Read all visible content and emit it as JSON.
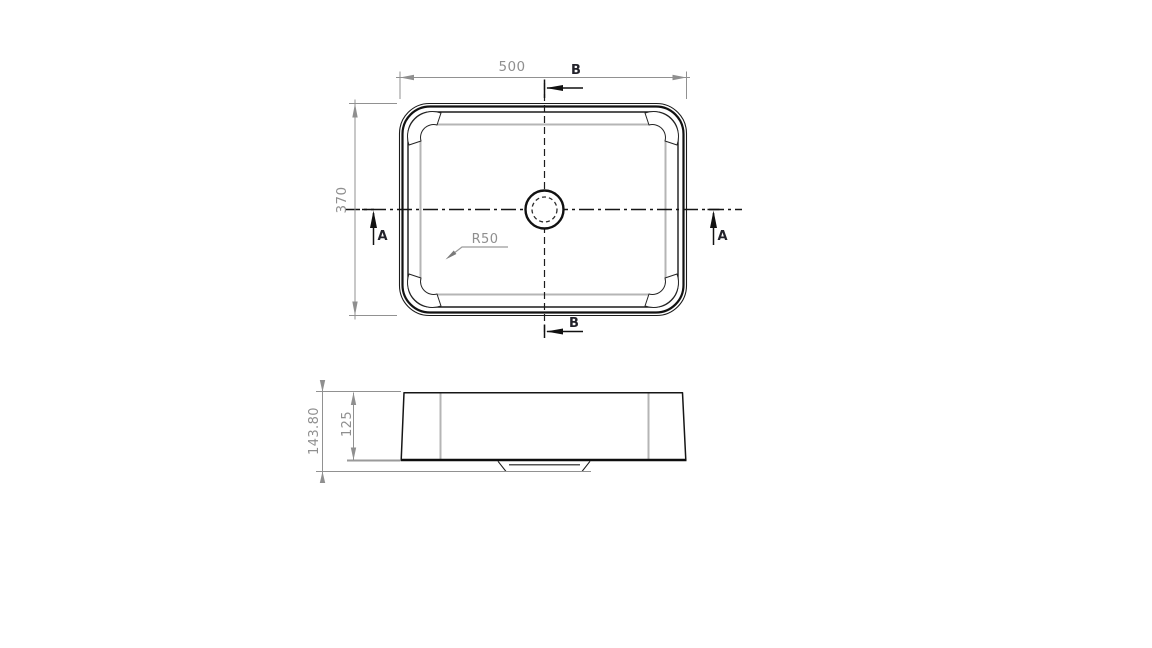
{
  "drawing": {
    "kind": "basin-technical-drawing",
    "top_view": {
      "dim_width": "500",
      "dim_height": "370",
      "radius_callout": "R50",
      "section_a_label": "A",
      "section_b_label": "B"
    },
    "side_view": {
      "dim_overall_height": "143.80",
      "dim_body_height": "125"
    },
    "colors": {
      "object_line": "#1b1b1b",
      "dimension": "#8f8f8f",
      "tangent_line": "#b5b5b5",
      "background": "#ffffff"
    }
  }
}
